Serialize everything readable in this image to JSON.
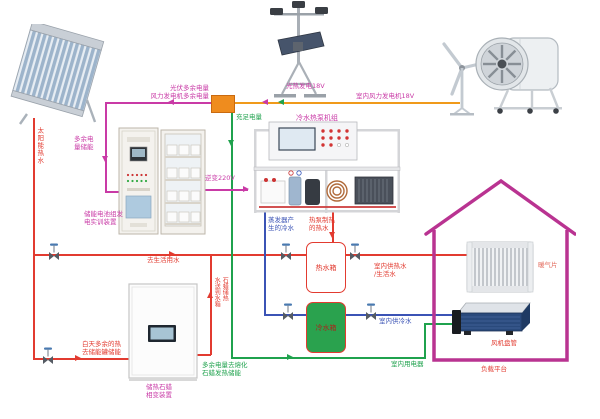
{
  "diagram_title": "太阳能·风能综合能源系统示意",
  "devices": {
    "solar_collector_flow": "太阳能热水",
    "tracker_label": "光热发电18V",
    "wind_label": "室内风力发电机18V",
    "battery_cabinet_l1": "储能电池组发",
    "battery_cabinet_l2": "电实训装置",
    "heat_pump_label": "冷水热泵机组",
    "paraffin_cabinet_l1": "储热石蜡",
    "paraffin_cabinet_l2": "相变装置",
    "hot_tank_label": "热水箱",
    "cold_tank_label": "冷水箱",
    "radiator_label": "暖气片",
    "fan_coil_label": "风机盘管",
    "load_platform_label": "负载平台"
  },
  "flows": {
    "pv_surplus": "光伏多余电量",
    "wind_surplus": "风力发电机多余电量",
    "surplus_storage_l1": "多余电",
    "surplus_storage_l2": "量储能",
    "sufficient_power": "充足电量",
    "inverter": "逆变220V",
    "evaporator_cold_l1": "蒸发器产",
    "evaporator_cold_l2": "生的冷水",
    "heatpump_hot_l1": "热泵制热",
    "heatpump_hot_l2": "的热水",
    "to_domestic": "去生活用水",
    "indoor_hot_l1": "室内供热水",
    "indoor_hot_l2": "/生活水",
    "indoor_cold": "室内供冷水",
    "indoor_power": "室内用电器",
    "day_heat_l1": "白天多余的热",
    "day_heat_l2": "去储能罐储能",
    "melt_l1": "多余电量去熔化",
    "melt_l2": "石蜡发热储能",
    "to_tank_col_left": "水送到水箱",
    "to_tank_col_right": "石蜡储热"
  },
  "colors": {
    "hot_water_red": "#e23b30",
    "cold_water_blue": "#3b53b5",
    "surplus_pink": "#c93aa6",
    "grid_orange": "#f09a1a",
    "power_green": "#1fa24d",
    "house_magenta": "#b93391",
    "cold_tank_green": "#2aa24e",
    "junction_orange": "#ef8c1e"
  }
}
